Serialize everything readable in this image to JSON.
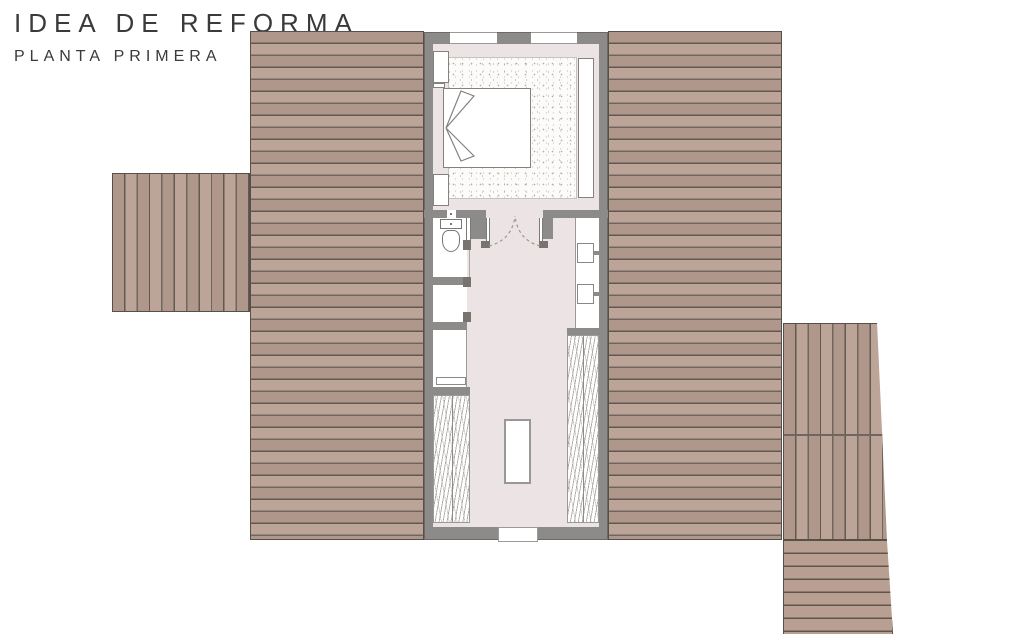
{
  "title": {
    "main": "IDEA DE REFORMA",
    "subtitle": "PLANTA PRIMERA"
  },
  "colors": {
    "roof_wood": "#b89f92",
    "roof_line": "#675e55",
    "wall": "#8d8b89",
    "interior_floor": "#ece4e4",
    "fixture_white": "#ffffff",
    "fixture_line": "#85827e",
    "outline": "#57504a"
  },
  "plan": {
    "type": "architectural-floor-plan",
    "floor": "first floor",
    "elements": [
      "left-roof",
      "right-roof",
      "left-deck",
      "right-deck",
      "right-deck-steps",
      "bedroom-carpet",
      "bed",
      "nightstand-top",
      "nightstand-bottom",
      "wardrobe",
      "double-door",
      "toilet-room",
      "toilet",
      "storage-room",
      "shelf-room",
      "shelf",
      "vanity-counter",
      "sink-top",
      "sink-bottom",
      "eaves-hatch-left",
      "eaves-hatch-right",
      "stair-void",
      "bottom-window",
      "top-window-left",
      "top-window-right"
    ]
  }
}
